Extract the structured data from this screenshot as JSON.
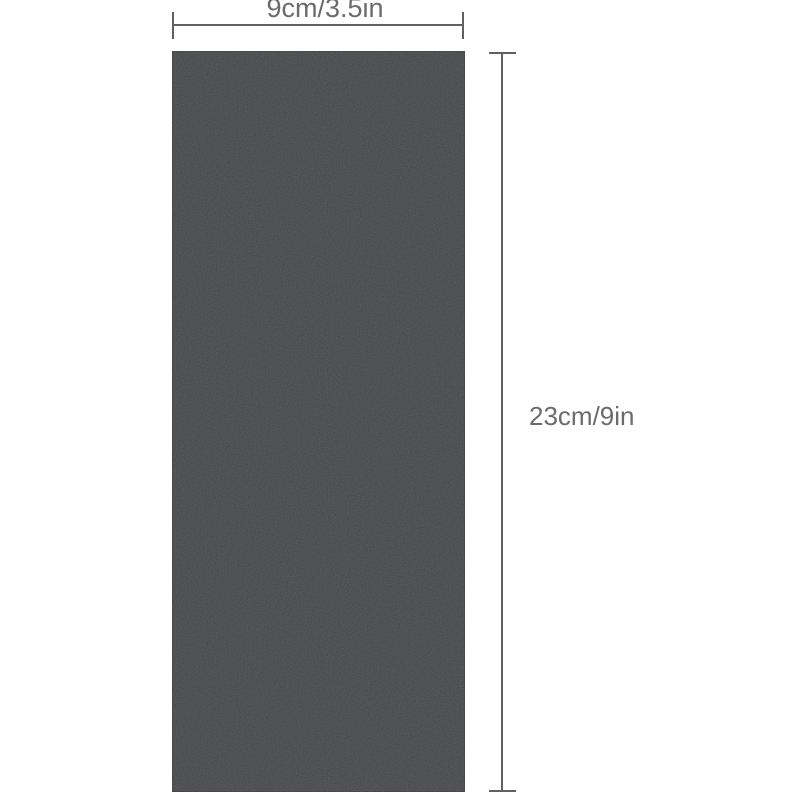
{
  "diagram": {
    "description": "black textured rectangular sheet with measurement annotations",
    "dimensions": {
      "width_label": "9cm/3.5in",
      "height_label": "23cm/9in"
    }
  },
  "colors": {
    "background": "#ffffff",
    "sheet_base": "#3a3b3d",
    "sheet_edge": "#2d2e30",
    "dimension_line": "#5f6061",
    "label_text": "#6a6b6d"
  }
}
